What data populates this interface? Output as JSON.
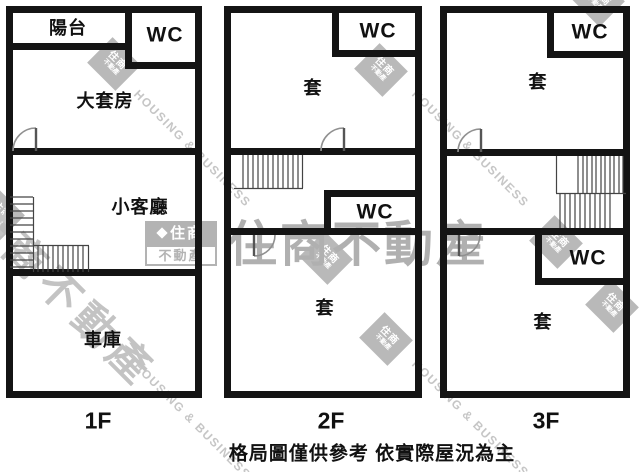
{
  "floors": [
    {
      "label": "1F",
      "rooms": {
        "balcony": "陽台",
        "wc_top": "WC",
        "master_suite": "大套房",
        "living_room": "小客廳",
        "garage": "車庫"
      }
    },
    {
      "label": "2F",
      "rooms": {
        "suite_top": "套",
        "wc_top": "WC",
        "wc_mid": "WC",
        "suite_bottom": "套"
      }
    },
    {
      "label": "3F",
      "rooms": {
        "suite_top": "套",
        "wc_top": "WC",
        "wc_mid": "WC",
        "suite_bottom": "套"
      }
    }
  ],
  "caption": "格局圖僅供參考 依實際屋況為主",
  "watermark": {
    "brand_cn": "住商不動產",
    "brand_en": "HOUSING & BUSINESS",
    "logo_line1": "住商",
    "logo_line2": "不動產"
  },
  "colors": {
    "wall": "#141414",
    "watermark_gray": "#b3b3b3"
  }
}
